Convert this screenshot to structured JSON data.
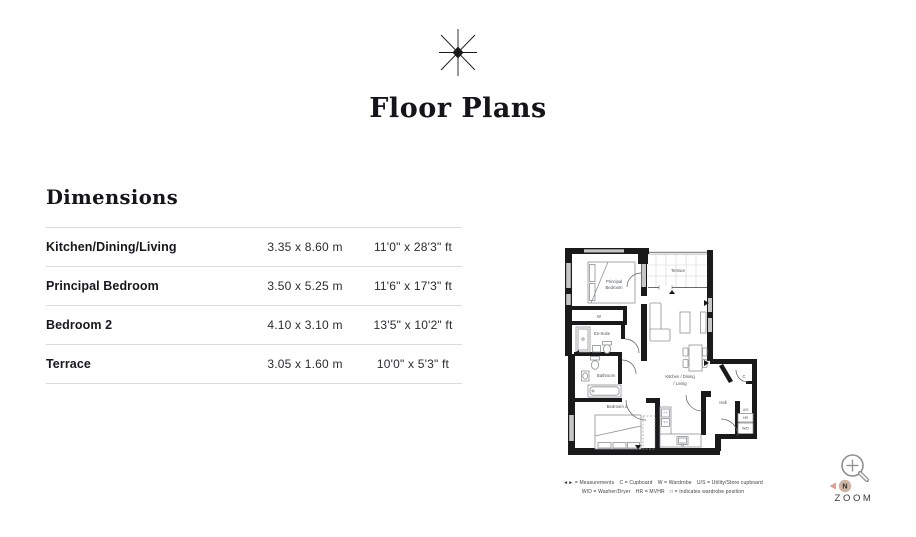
{
  "header": {
    "title": "Floor Plans"
  },
  "dimensions": {
    "heading": "Dimensions",
    "rows": [
      {
        "room": "Kitchen/Dining/Living",
        "metric": "3.35 x 8.60 m",
        "imperial": "11'0\" x 28'3\" ft"
      },
      {
        "room": "Principal Bedroom",
        "metric": "3.50 x 5.25 m",
        "imperial": "11'6\" x 17'3\" ft"
      },
      {
        "room": "Bedroom 2",
        "metric": "4.10 x 3.10 m",
        "imperial": "13'5\" x 10'2\" ft"
      },
      {
        "room": "Terrace",
        "metric": "3.05 x 1.60 m",
        "imperial": "10'0\" x 5'3\" ft"
      }
    ]
  },
  "floorplan": {
    "labels": {
      "principal_line1": "Principal",
      "principal_line2": "Bedroom",
      "terrace": "Terrace",
      "wardrobe": "W",
      "ensuite": "En-Suite",
      "bathroom": "Bathroom",
      "bedroom2": "Bedroom 2",
      "kitchen_line1": "Kitchen / Dining",
      "kitchen_line2": "/ Living",
      "hall": "Hall",
      "cupboard": "C",
      "utility": "U/S",
      "hr": "HR",
      "wd": "W/D",
      "appliance_top": "O-S",
      "appliance_bottom": "S.O"
    },
    "legend_line1": "◄► = Measurements C = Cupboard W = Wardrobe U/S = Utility/Store cupboard",
    "legend_line2": "W/D = Washer/Dryer HR = MVHR □ = Indicates wardrobe position"
  },
  "zoom_control": {
    "label": "ZOOM",
    "cursor_badge": "N"
  },
  "colors": {
    "wall": "#1a1a1a",
    "text": "#14141b",
    "table_border": "#dcdcdc",
    "furniture": "#8d9196",
    "cursor_badge_fill": "#c3a18c",
    "cursor_arrow": "#c0522b"
  }
}
